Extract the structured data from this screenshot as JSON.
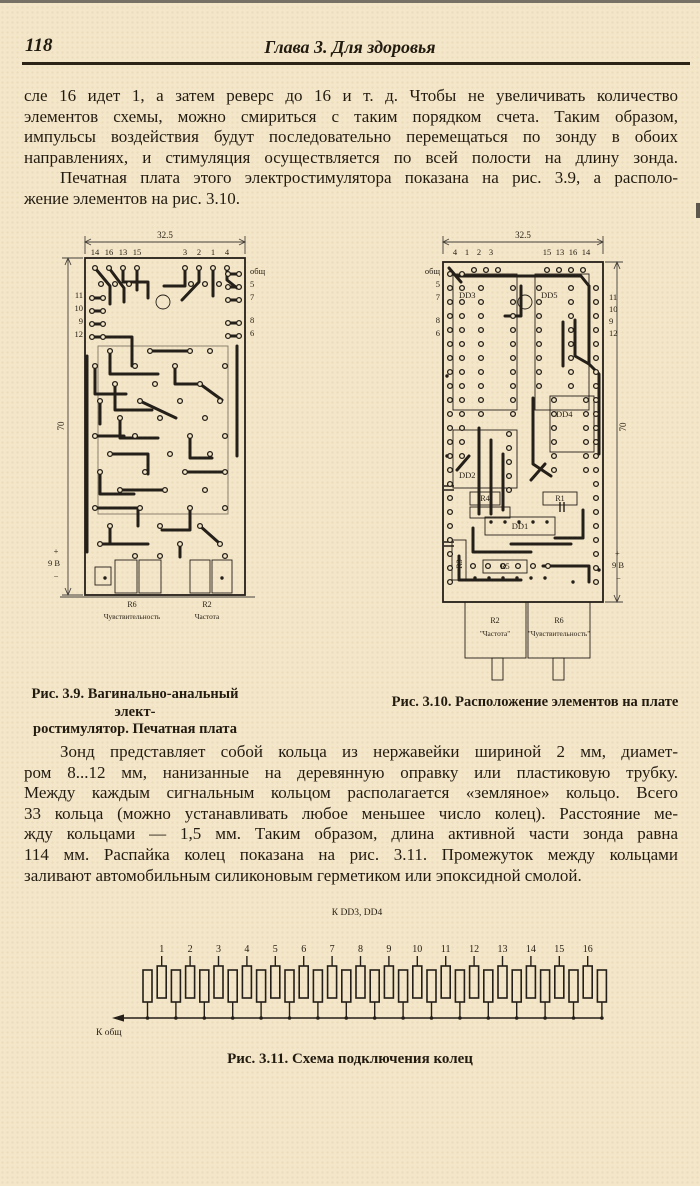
{
  "page": {
    "number": "118",
    "chapter_header": "Глава 3. Для здоровья"
  },
  "paragraphs": {
    "block1_lines": [
      "сле 16 идет 1, а затем реверс до 16 и т. д. Чтобы не увеличивать количество",
      "элементов схемы, можно смириться с таким порядком счета. Таким образом,",
      "импульсы воздействия будут последовательно перемещаться по зонду в обоих",
      "направлениях, и стимуляция осуществляется по всей полости на длину зонда.",
      "Печатная плата этого электростимулятора показана на рис. 3.9, а располо-",
      "жение элементов на рис. 3.10."
    ],
    "block2_lines": [
      "Зонд представляет собой кольца из нержавейки шириной 2 мм, диамет-",
      "ром 8...12 мм, нанизанные на деревянную оправку или пластиковую трубку.",
      "Между каждым сигнальным кольцом располагается «земляное» кольцо. Всего",
      "33 кольца (можно устанавливать любое меньшее число колец). Расстояние ме-",
      "жду кольцами — 1,5 мм. Таким образом, длина активной части зонда равна",
      "114 мм. Распайка колец показана на рис. 3.11. Промежуток между кольцами",
      "заливают автомобильным силиконовым герметиком или эпоксидной смолой."
    ]
  },
  "fig39": {
    "caption_line1": "Рис. 3.9.  Вагинально-анальный элект-",
    "caption_line2": "ростимулятор. Печатная плата",
    "dim_width": "32.5",
    "dim_height": "70",
    "top_pins_left": [
      "14",
      "16",
      "13",
      "15"
    ],
    "top_pins_right": [
      "3",
      "2",
      "1",
      "4"
    ],
    "right_labels": [
      "общ",
      "5",
      "7",
      "8",
      "6"
    ],
    "left_labels": [
      "11",
      "10",
      "9",
      "12"
    ],
    "power_plus": "+",
    "power_label": "9 В",
    "power_minus": "−",
    "pot1_ref": "R6",
    "pot1_name": "Чувствительность",
    "pot2_ref": "R2",
    "pot2_name": "Частота"
  },
  "fig310": {
    "caption": "Рис. 3.10. Расположение элементов на плате",
    "dim_width": "32.5",
    "dim_height": "70",
    "top_pins_left": [
      "4",
      "1",
      "2",
      "3"
    ],
    "top_pins_right": [
      "15",
      "13",
      "16",
      "14"
    ],
    "left_labels": [
      "общ",
      "5",
      "7",
      "8",
      "6"
    ],
    "right_labels": [
      "11",
      "10",
      "9",
      "12"
    ],
    "components": {
      "dd1": "DD1",
      "dd2": "DD2",
      "dd3": "DD3",
      "dd4": "DD4",
      "dd5": "DD5",
      "r1": "R1",
      "r3": "R3",
      "r4": "R4",
      "r5": "R5"
    },
    "power_plus": "+",
    "power_label": "9 В",
    "power_minus": "−",
    "pot_left_ref": "R2",
    "pot_left_name": "\"Частота\"",
    "pot_right_ref": "R6",
    "pot_right_name": "\"Чувствительность\""
  },
  "fig311": {
    "top_label": "К DD3, DD4",
    "bottom_label": "К общ",
    "caption": "Рис. 3.11. Схема подключения колец",
    "ring_count": 33,
    "ring_numbers": [
      "1",
      "2",
      "3",
      "4",
      "5",
      "6",
      "7",
      "8",
      "9",
      "10",
      "11",
      "12",
      "13",
      "14",
      "15",
      "16"
    ]
  }
}
